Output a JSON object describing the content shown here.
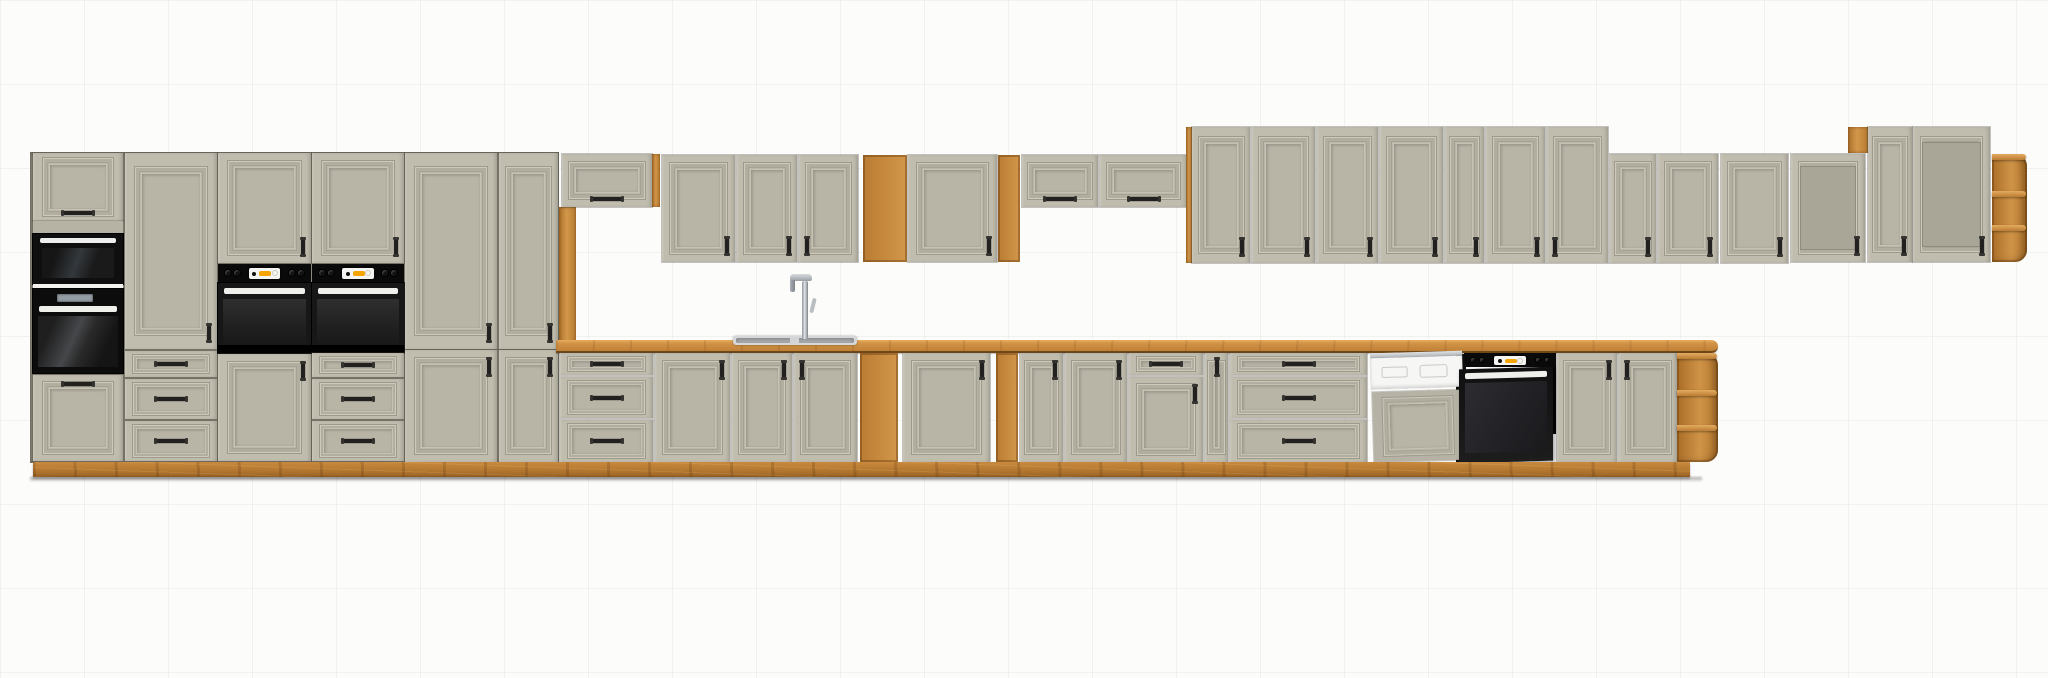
{
  "scene": {
    "description": "3D product render of a long modular kitchen set: clay-grey framed cabinet fronts with artisan oak worktop, plinth and open shelves; built-in microwave, three ovens, dishwasher, sink with chrome faucet, wine racks and glass display wall units on a white background",
    "width": 2048,
    "height": 678,
    "background": "#fcfcfb"
  },
  "colors": {
    "front": "#c0bcae",
    "front_shadow": "#a6a294",
    "carcass": "#8c887a",
    "oak": "#c8893f",
    "oak_light": "#dca04f",
    "oak_dark": "#9a6224",
    "counter_top": "#e7ae5f",
    "appliance_black": "#0d0d0d",
    "oven_glass": "#2a2a2a",
    "handle": "#22211f",
    "white_trim": "#efefec",
    "display_yellow": "#f4a500",
    "steel": "#c9cdd0",
    "dishwasher_white": "#f6f6f5",
    "wine_slot": "#3a2a1a"
  },
  "units": [
    {
      "n": "tall-run-carcass",
      "k": "carcass",
      "x": 30,
      "y": 152,
      "w": 529,
      "h": 311
    },
    {
      "n": "tall-cabinet-top-door",
      "k": "door",
      "x": 33,
      "y": 153,
      "w": 90,
      "h": 68,
      "hd": "bch"
    },
    {
      "n": "tall-cabinet-filler",
      "k": "filler",
      "x": 33,
      "y": 221,
      "w": 90,
      "h": 13
    },
    {
      "n": "microwave",
      "k": "microwave",
      "x": 33,
      "y": 234,
      "w": 90,
      "h": 50
    },
    {
      "n": "shelf-trim",
      "k": "shelfline",
      "x": 33,
      "y": 284,
      "w": 90,
      "h": 5
    },
    {
      "n": "built-in-oven",
      "k": "oven1",
      "x": 33,
      "y": 289,
      "w": 90,
      "h": 84
    },
    {
      "n": "tall-cabinet-bottom-door",
      "k": "door",
      "x": 33,
      "y": 375,
      "w": 90,
      "h": 86,
      "hd": "tch"
    },
    {
      "n": "tall-cabinet-door",
      "k": "door",
      "x": 125,
      "y": 153,
      "w": 92,
      "h": 196,
      "hd": "br"
    },
    {
      "n": "base-drawer",
      "k": "drawer",
      "x": 125,
      "y": 351,
      "w": 92,
      "h": 26,
      "hd": "ch"
    },
    {
      "n": "base-drawer",
      "k": "drawer",
      "x": 125,
      "y": 379,
      "w": 92,
      "h": 40,
      "hd": "ch"
    },
    {
      "n": "base-drawer",
      "k": "drawer",
      "x": 125,
      "y": 421,
      "w": 92,
      "h": 40,
      "hd": "ch"
    },
    {
      "n": "tall-cabinet-door",
      "k": "door",
      "x": 218,
      "y": 153,
      "w": 93,
      "h": 110,
      "hd": "br"
    },
    {
      "n": "built-in-oven-with-panel",
      "k": "walloven",
      "x": 218,
      "y": 264,
      "w": 93,
      "h": 89
    },
    {
      "n": "tall-cabinet-bottom-door",
      "k": "door",
      "x": 218,
      "y": 354,
      "w": 93,
      "h": 107,
      "hd": "tr"
    },
    {
      "n": "tall-cabinet-door",
      "k": "door",
      "x": 312,
      "y": 153,
      "w": 92,
      "h": 110,
      "hd": "br"
    },
    {
      "n": "built-in-oven-with-panel",
      "k": "walloven",
      "x": 312,
      "y": 264,
      "w": 92,
      "h": 89
    },
    {
      "n": "base-drawer",
      "k": "drawer",
      "x": 312,
      "y": 353,
      "w": 92,
      "h": 24,
      "hd": "ch"
    },
    {
      "n": "base-drawer",
      "k": "drawer",
      "x": 312,
      "y": 379,
      "w": 92,
      "h": 40,
      "hd": "ch"
    },
    {
      "n": "base-drawer",
      "k": "drawer",
      "x": 312,
      "y": 421,
      "w": 92,
      "h": 40,
      "hd": "ch"
    },
    {
      "n": "tall-cabinet-door",
      "k": "door",
      "x": 405,
      "y": 153,
      "w": 92,
      "h": 196,
      "hd": "br"
    },
    {
      "n": "tall-cabinet-bottom-door",
      "k": "door",
      "x": 405,
      "y": 350,
      "w": 92,
      "h": 112,
      "hd": "tr"
    },
    {
      "n": "tall-cabinet-door",
      "k": "door",
      "x": 499,
      "y": 153,
      "w": 59,
      "h": 196,
      "hd": "br"
    },
    {
      "n": "tall-cabinet-bottom-door",
      "k": "door",
      "x": 499,
      "y": 350,
      "w": 59,
      "h": 112,
      "hd": "tr"
    },
    {
      "n": "oak-side-panel",
      "k": "oakstrip",
      "x": 559,
      "y": 207,
      "w": 17,
      "h": 136
    },
    {
      "n": "wall-flip-cabinet",
      "k": "flip",
      "x": 562,
      "y": 154,
      "w": 90,
      "h": 53,
      "hd": "bch"
    },
    {
      "n": "oak-side-panel",
      "k": "oakstrip",
      "x": 652,
      "y": 154,
      "w": 8,
      "h": 53
    },
    {
      "n": "wall-cabinet-door",
      "k": "door",
      "x": 662,
      "y": 155,
      "w": 73,
      "h": 107,
      "hd": "br"
    },
    {
      "n": "wall-cabinet-door",
      "k": "door",
      "x": 737,
      "y": 155,
      "w": 60,
      "h": 107,
      "hd": "br"
    },
    {
      "n": "wall-cabinet-door",
      "k": "door",
      "x": 799,
      "y": 155,
      "w": 59,
      "h": 107,
      "hd": "bl"
    },
    {
      "n": "wall-open-shelf",
      "k": "openshelf",
      "x": 863,
      "y": 155,
      "w": 44,
      "h": 107,
      "rows": 3
    },
    {
      "n": "wall-cabinet-door",
      "k": "door",
      "x": 908,
      "y": 155,
      "w": 89,
      "h": 107,
      "hd": "br"
    },
    {
      "n": "wall-wine-rack",
      "k": "winerack",
      "x": 998,
      "y": 155,
      "w": 22,
      "h": 107,
      "rows": 5
    },
    {
      "n": "wall-flip-cabinet",
      "k": "flip",
      "x": 1022,
      "y": 155,
      "w": 76,
      "h": 52,
      "hd": "bch"
    },
    {
      "n": "wall-flip-cabinet",
      "k": "flip",
      "x": 1100,
      "y": 155,
      "w": 87,
      "h": 52,
      "hd": "bch"
    },
    {
      "n": "oak-side-panel",
      "k": "oakstrip",
      "x": 1186,
      "y": 127,
      "w": 6,
      "h": 136
    },
    {
      "n": "wall-cabinet-door",
      "k": "door",
      "x": 1192,
      "y": 127,
      "w": 58,
      "h": 136,
      "hd": "br"
    },
    {
      "n": "wall-cabinet-door",
      "k": "door",
      "x": 1252,
      "y": 127,
      "w": 63,
      "h": 136,
      "hd": "br"
    },
    {
      "n": "wall-cabinet-door",
      "k": "door",
      "x": 1317,
      "y": 127,
      "w": 61,
      "h": 136,
      "hd": "br"
    },
    {
      "n": "wall-cabinet-door",
      "k": "door",
      "x": 1380,
      "y": 127,
      "w": 63,
      "h": 136,
      "hd": "br"
    },
    {
      "n": "wall-cabinet-door",
      "k": "door",
      "x": 1445,
      "y": 127,
      "w": 39,
      "h": 136,
      "hd": "br"
    },
    {
      "n": "wall-cabinet-door",
      "k": "door",
      "x": 1486,
      "y": 127,
      "w": 59,
      "h": 136,
      "hd": "br"
    },
    {
      "n": "wall-cabinet-door",
      "k": "door",
      "x": 1547,
      "y": 127,
      "w": 61,
      "h": 136,
      "hd": "bl"
    },
    {
      "n": "wall-cabinet-door",
      "k": "door",
      "x": 1610,
      "y": 154,
      "w": 46,
      "h": 109,
      "hd": "br"
    },
    {
      "n": "wall-cabinet-door",
      "k": "door",
      "x": 1658,
      "y": 154,
      "w": 60,
      "h": 109,
      "hd": "br"
    },
    {
      "n": "countertop",
      "k": "counter",
      "x": 556,
      "y": 340,
      "w": 1162,
      "h": 13
    },
    {
      "n": "sink",
      "k": "sink",
      "x": 733,
      "y": 336,
      "w": 124,
      "h": 9
    },
    {
      "n": "faucet",
      "k": "faucet",
      "x": 786,
      "y": 274,
      "w": 34,
      "h": 66
    },
    {
      "n": "base-drawer",
      "k": "drawer",
      "x": 560,
      "y": 353,
      "w": 93,
      "h": 22,
      "hd": "ch"
    },
    {
      "n": "base-drawer",
      "k": "drawer",
      "x": 560,
      "y": 377,
      "w": 93,
      "h": 41,
      "hd": "ch"
    },
    {
      "n": "base-drawer",
      "k": "drawer",
      "x": 560,
      "y": 420,
      "w": 93,
      "h": 42,
      "hd": "ch"
    },
    {
      "n": "base-cabinet-door",
      "k": "door",
      "x": 655,
      "y": 353,
      "w": 75,
      "h": 109,
      "hd": "tr"
    },
    {
      "n": "sink-base-door",
      "k": "door",
      "x": 732,
      "y": 353,
      "w": 60,
      "h": 109,
      "hd": "tr"
    },
    {
      "n": "sink-base-door",
      "k": "door",
      "x": 794,
      "y": 353,
      "w": 63,
      "h": 109,
      "hd": "tl"
    },
    {
      "n": "base-open-shelf",
      "k": "openshelf",
      "x": 860,
      "y": 353,
      "w": 38,
      "h": 109,
      "rows": 3
    },
    {
      "n": "base-cabinet-door",
      "k": "door",
      "x": 903,
      "y": 353,
      "w": 87,
      "h": 109,
      "hd": "tr"
    },
    {
      "n": "base-wine-rack",
      "k": "winerack",
      "x": 996,
      "y": 353,
      "w": 22,
      "h": 109,
      "rows": 4
    },
    {
      "n": "base-cabinet-door",
      "k": "door",
      "x": 1020,
      "y": 353,
      "w": 43,
      "h": 109,
      "hd": "tr"
    },
    {
      "n": "base-cabinet-door",
      "k": "door",
      "x": 1065,
      "y": 353,
      "w": 62,
      "h": 109,
      "hd": "tr"
    },
    {
      "n": "base-drawer",
      "k": "drawer",
      "x": 1129,
      "y": 353,
      "w": 74,
      "h": 22,
      "hd": "ch"
    },
    {
      "n": "base-cabinet-door",
      "k": "door",
      "x": 1129,
      "y": 377,
      "w": 74,
      "h": 85,
      "hd": "tr"
    },
    {
      "n": "narrow-base-door",
      "k": "door",
      "x": 1205,
      "y": 353,
      "w": 23,
      "h": 109,
      "hd": "tcv"
    },
    {
      "n": "base-drawer",
      "k": "drawer",
      "x": 1230,
      "y": 353,
      "w": 137,
      "h": 22,
      "hd": "ch"
    },
    {
      "n": "base-drawer",
      "k": "drawer",
      "x": 1230,
      "y": 377,
      "w": 137,
      "h": 41,
      "hd": "ch"
    },
    {
      "n": "base-drawer",
      "k": "drawer",
      "x": 1230,
      "y": 420,
      "w": 137,
      "h": 42,
      "hd": "ch"
    },
    {
      "n": "dishwasher",
      "k": "dishwasher",
      "x": 1370,
      "y": 352,
      "w": 92,
      "h": 110
    },
    {
      "n": "built-under-oven-open",
      "k": "underoven",
      "x": 1464,
      "y": 353,
      "w": 92,
      "h": 109
    },
    {
      "n": "base-cabinet-door",
      "k": "door",
      "x": 1557,
      "y": 353,
      "w": 60,
      "h": 109,
      "hd": "tr"
    },
    {
      "n": "base-cabinet-door",
      "k": "door",
      "x": 1619,
      "y": 353,
      "w": 58,
      "h": 109,
      "hd": "tl"
    },
    {
      "n": "base-corner-shelf",
      "k": "cornershelf",
      "x": 1677,
      "y": 353,
      "w": 41,
      "h": 109
    },
    {
      "n": "plinth",
      "k": "plinth",
      "x": 33,
      "y": 462,
      "w": 1657,
      "h": 15
    },
    {
      "n": "floor-shadow",
      "k": "shadow",
      "x": 30,
      "y": 477,
      "w": 1672,
      "h": 5
    },
    {
      "n": "wall-cabinet-door",
      "k": "door",
      "x": 1721,
      "y": 154,
      "w": 67,
      "h": 109,
      "hd": "br"
    },
    {
      "n": "glass-display-cabinet",
      "k": "glasscab",
      "x": 1791,
      "y": 154,
      "w": 74,
      "h": 108,
      "cols": 2,
      "rows": 2,
      "hd": "br"
    },
    {
      "n": "oak-open-box",
      "k": "oakbox",
      "x": 1848,
      "y": 127,
      "w": 20,
      "h": 26
    },
    {
      "n": "wall-cabinet-door",
      "k": "door",
      "x": 1868,
      "y": 127,
      "w": 44,
      "h": 135,
      "hd": "br"
    },
    {
      "n": "glass-display-cabinet",
      "k": "glasscab",
      "x": 1913,
      "y": 127,
      "w": 77,
      "h": 135,
      "cols": 2,
      "rows": 3,
      "hd": "br"
    },
    {
      "n": "wall-corner-shelf",
      "k": "cornershelf",
      "x": 1992,
      "y": 154,
      "w": 35,
      "h": 108
    }
  ]
}
